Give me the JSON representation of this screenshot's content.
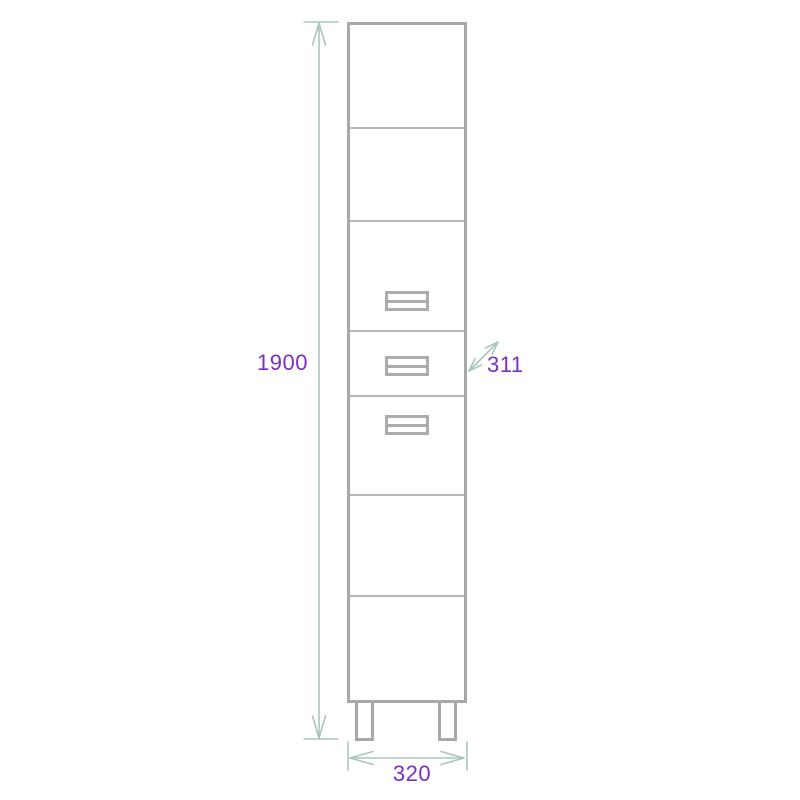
{
  "diagram": {
    "kind": "furniture-dimension-drawing",
    "subject": "tall-cabinet-front-view",
    "dimension_labels": {
      "height": "1900",
      "width": "320",
      "depth": "311"
    },
    "colors": {
      "dimension_text": "#7C2EC0",
      "dimension_line": "#A9C6BF",
      "cabinet_outline": "#A8A8A8",
      "background": "#FFFFFF"
    },
    "cabinet": {
      "section_count": 7,
      "drawer_handle_count": 3,
      "leg_count": 2
    }
  }
}
